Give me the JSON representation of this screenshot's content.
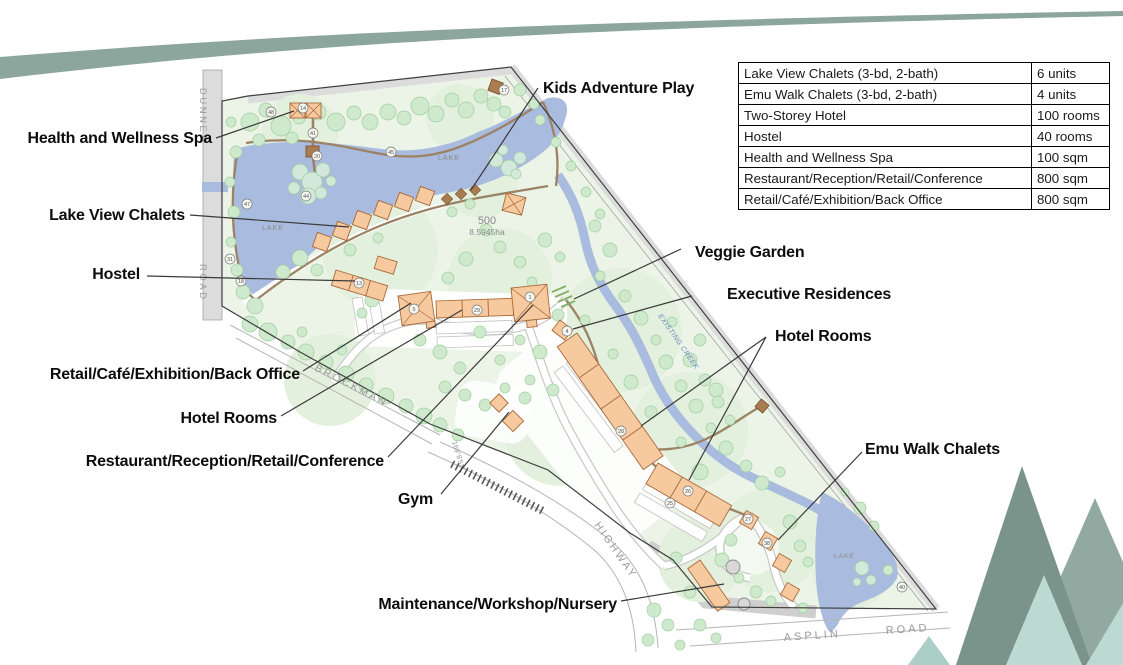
{
  "page": {
    "background": "#ffffff"
  },
  "decor": {
    "swoosh_color": "#8ca69d",
    "tree_dark": "#7b948b",
    "tree_mid": "#91a9a1",
    "tree_light": "#bcdad2",
    "tree_small": "#abcfc7"
  },
  "palette": {
    "site_green": "#ecf4e7",
    "lake_blue": "#a9bbde",
    "building_orange": "#f7c99e",
    "building_outline": "#a8693a",
    "path_brown": "#9c8365",
    "road_gray": "#d9d9d9"
  },
  "facility_table": {
    "rows": [
      {
        "name": "Lake View Chalets (3-bd, 2-bath)",
        "value": "6 units"
      },
      {
        "name": "Emu Walk Chalets (3-bd, 2-bath)",
        "value": "4 units"
      },
      {
        "name": "Two-Storey Hotel",
        "value": "100 rooms"
      },
      {
        "name": "Hostel",
        "value": "40 rooms"
      },
      {
        "name": "Health and Wellness Spa",
        "value": "100 sqm"
      },
      {
        "name": "Restaurant/Reception/Retail/Conference",
        "value": "800 sqm"
      },
      {
        "name": "Retail/Café/Exhibition/Back Office",
        "value": "800 sqm"
      }
    ]
  },
  "map_labels": {
    "kids_adventure_play": "Kids Adventure Play",
    "health_wellness_spa": "Health and Wellness Spa",
    "lake_view_chalets": "Lake View Chalets",
    "hostel": "Hostel",
    "retail_cafe": "Retail/Café/Exhibition/Back Office",
    "hotel_rooms_left": "Hotel Rooms",
    "restaurant": "Restaurant/Reception/Retail/Conference",
    "gym": "Gym",
    "maintenance": "Maintenance/Workshop/Nursery",
    "veggie_garden": "Veggie Garden",
    "executive_residences": "Executive Residences",
    "hotel_rooms_right": "Hotel Rooms",
    "emu_walk_chalets": "Emu Walk Chalets"
  },
  "map_text": {
    "road_left_name": "DUNNET",
    "road_left_type": "ROAD",
    "road_sw_name": "BROCKMAN",
    "road_sw_type": "HIGHWAY",
    "road_bottom_name": "ASPLIN",
    "road_bottom_type": "ROAD",
    "lake_top": "LAKE",
    "lake_top_2": "LAKE",
    "lake_bottom": "LAKE",
    "lot_number": "500",
    "lot_area": "8.5945ha",
    "creek": "EXISTING CREEK",
    "bearing": "169°8'52\""
  },
  "markers": [
    "14",
    "48",
    "41",
    "20",
    "45",
    "44",
    "47",
    "31",
    "18",
    "17",
    "13",
    "5",
    "29",
    "1",
    "4",
    "28",
    "26",
    "25",
    "27",
    "38",
    "40"
  ]
}
